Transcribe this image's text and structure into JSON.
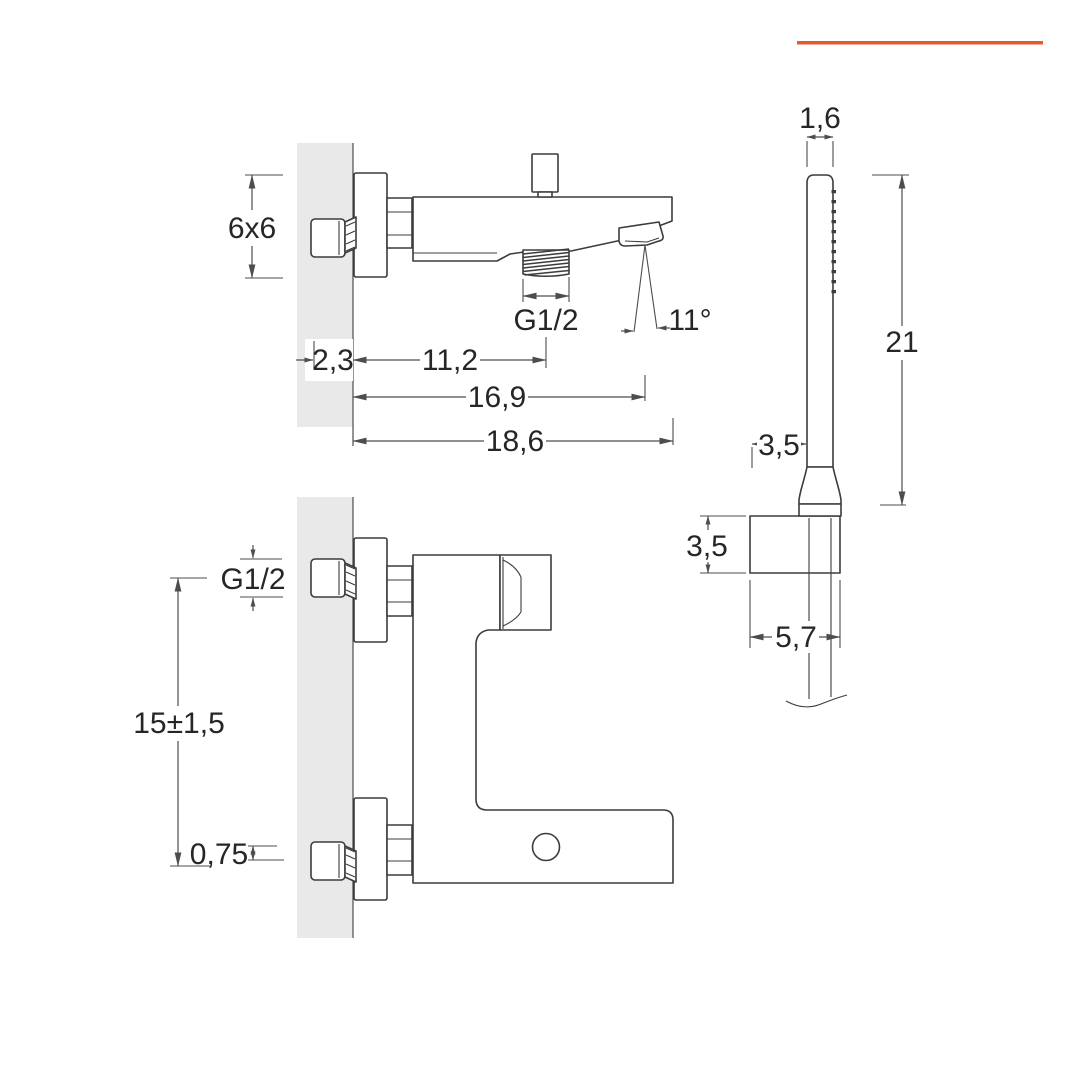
{
  "title": "Bath shower mixer technical dimensions drawing",
  "colors": {
    "accent": "#e8582c",
    "line": "#3c3c3c",
    "dim_line": "#4d4d4d",
    "wall": "#e9e9e9",
    "background": "#ffffff",
    "text": "#262626"
  },
  "views": {
    "side_view": {
      "name": "spout side view",
      "dims": {
        "flange_size": "6x6",
        "elbow_depth": "2,3",
        "spout_connection": "11,2",
        "outlet_reach": "16,9",
        "total_reach": "18,6",
        "thread": "G1/2",
        "outlet_angle": "11°"
      }
    },
    "front_view": {
      "name": "mixer front view",
      "dims": {
        "thread": "G1/2",
        "inlet_spacing": "15±1,5",
        "axis_offset": "0,75"
      }
    },
    "hand_shower": {
      "name": "hand shower side view",
      "dims": {
        "head_width": "1,6",
        "length": "21",
        "head_offset": "3,5",
        "bracket_height": "3,5",
        "bracket_width": "5,7"
      }
    }
  }
}
